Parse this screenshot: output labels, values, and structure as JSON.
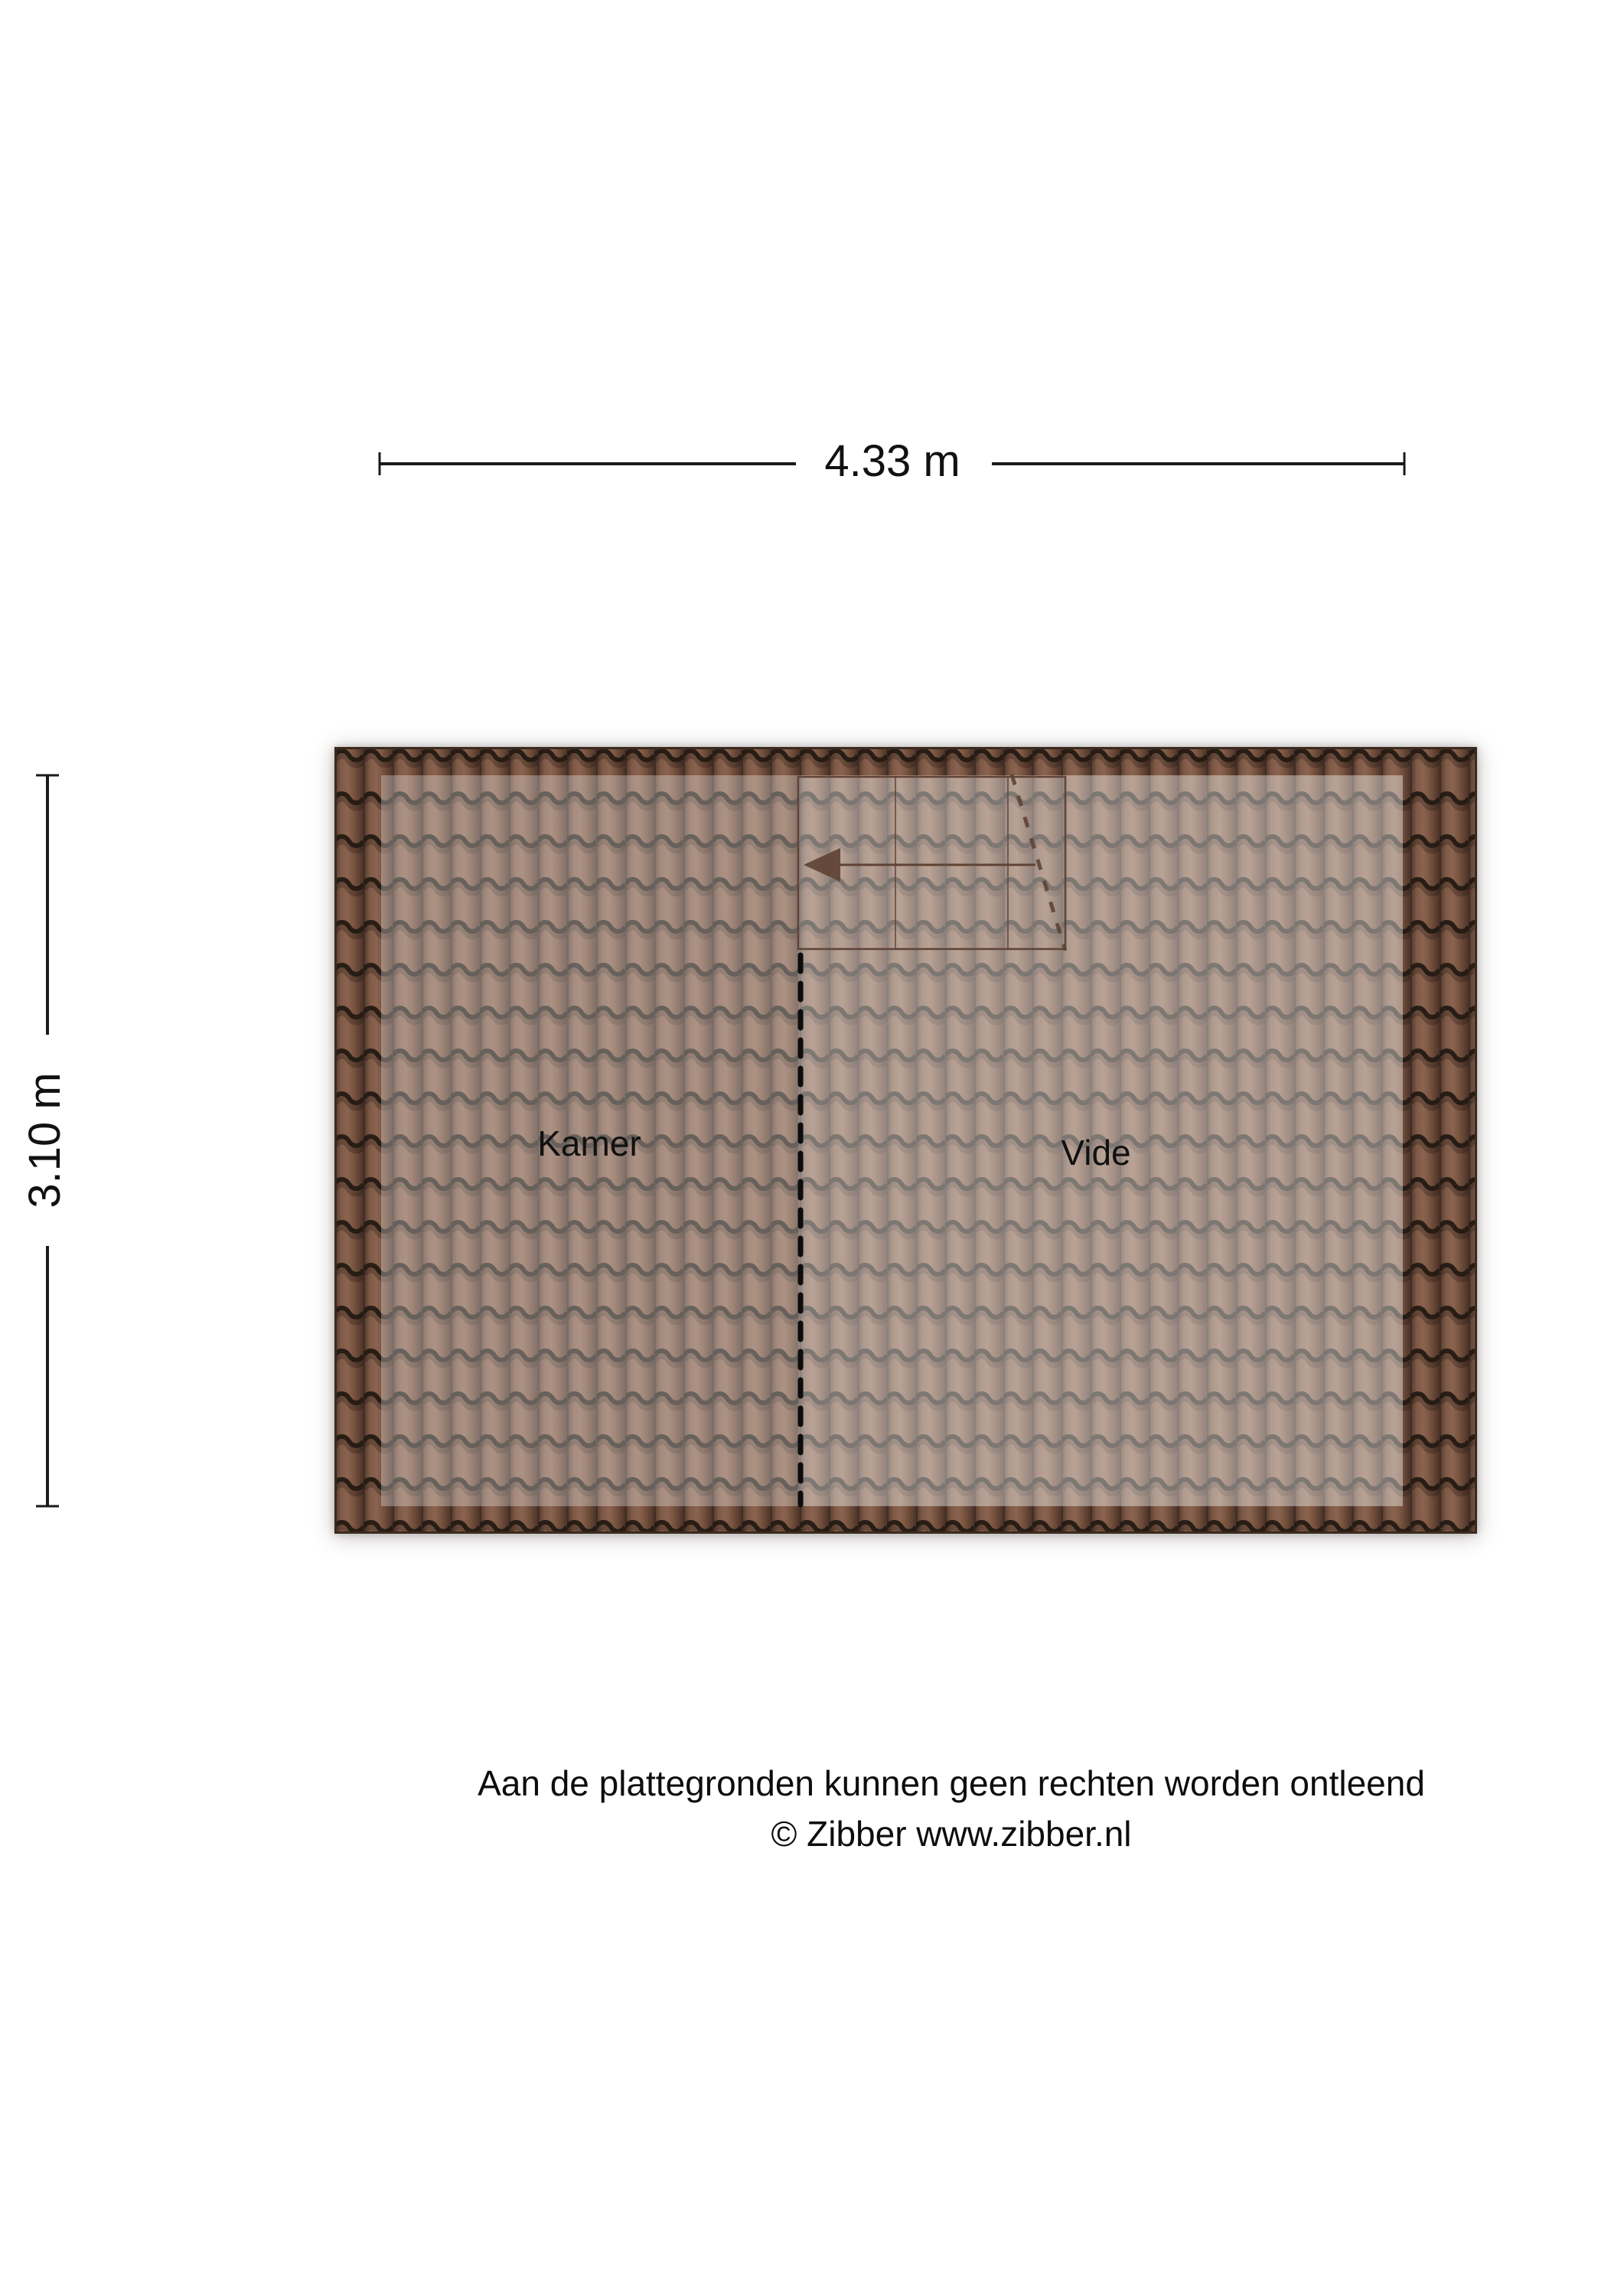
{
  "page": {
    "background": "#ffffff"
  },
  "plan": {
    "dimension_width": {
      "label": "4.33 m"
    },
    "dimension_height": {
      "label": "3.10 m"
    },
    "rooms": [
      {
        "name": "Kamer"
      },
      {
        "name": "Vide"
      }
    ]
  },
  "footer": {
    "disclaimer": "Aan de plattegronden kunnen geen rechten worden ontleend",
    "copyright": "© Zibber www.zibber.nl"
  },
  "colors": {
    "roof_tile_body": "#74513f",
    "roof_tile_groove": "#241a13",
    "kamer_tint": "#9d8674",
    "vide_tint": "#b3958a",
    "stair_symbol_brown": "#5f4335",
    "divider_black": "#0d0d0d",
    "dimension_text": "#111111"
  }
}
